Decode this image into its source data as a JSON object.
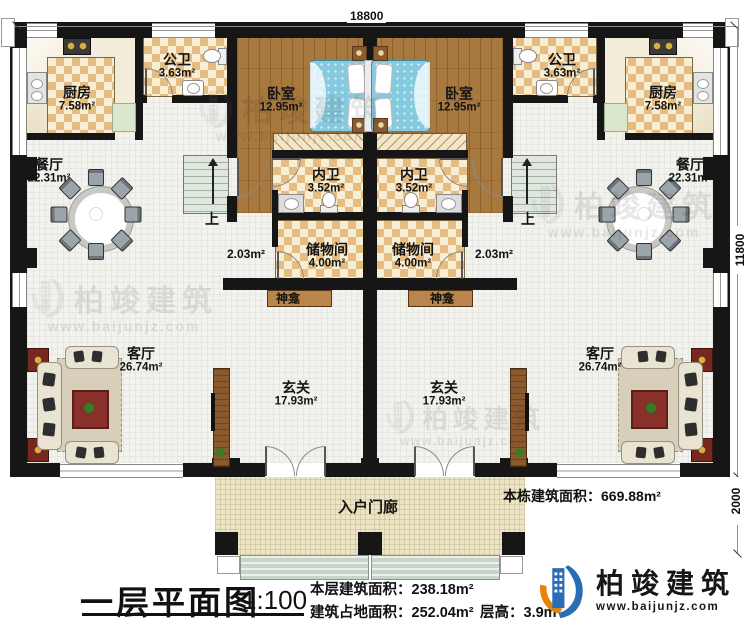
{
  "dimensions": {
    "top": "18800",
    "right_upper": "11800",
    "right_lower": "2000"
  },
  "rooms": {
    "kitchen": {
      "name": "厨房",
      "area": "7.58m²"
    },
    "public_bath": {
      "name": "公卫",
      "area": "3.63m²"
    },
    "bedroom": {
      "name": "卧室",
      "area": "12.95m²"
    },
    "dining": {
      "name": "餐厅",
      "area": "22.31m²"
    },
    "inner_bath": {
      "name": "内卫",
      "area": "3.52m²"
    },
    "storage": {
      "name": "储物间",
      "area": "4.00m²"
    },
    "shrine": {
      "name": "神龛"
    },
    "living": {
      "name": "客厅",
      "area": "26.74m²"
    },
    "foyer": {
      "name": "玄关",
      "area": "17.93m²"
    },
    "porch": {
      "name": "入户门廊"
    },
    "landing": {
      "area": "2.03m²"
    },
    "stairs": {
      "up": "上"
    }
  },
  "annotations": {
    "building_total": "本栋建筑面积：669.88m²"
  },
  "footer": {
    "title": "一层平面图",
    "scale": "1:100",
    "floor_area": "本层建筑面积：238.18m²",
    "footprint": "建筑占地面积：252.04m²",
    "height": "层高：3.9m"
  },
  "brand": {
    "name": "柏竣建筑",
    "url": "www.baijunjz.com"
  },
  "watermark": {
    "name": "柏竣建筑",
    "url": "www.baijunjz.com"
  },
  "colors": {
    "wall": "#161616",
    "checker": "#e5bd82",
    "wood": "#a8793f",
    "accent_blue": "#2a6db5",
    "accent_orange": "#e8830a"
  }
}
